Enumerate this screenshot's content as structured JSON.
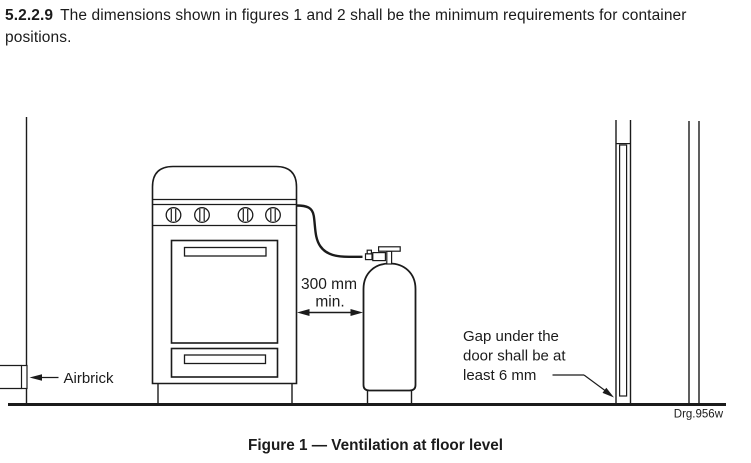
{
  "clause": {
    "number": "5.2.2.9",
    "text": "The dimensions shown in figures 1 and 2 shall be the minimum requirements for container positions."
  },
  "figure": {
    "caption": "Figure 1 — Ventilation at floor level",
    "drawing_ref": "Drg.956w",
    "labels": {
      "airbrick": "Airbrick",
      "clearance_value": "300 mm",
      "clearance_qualifier": "min.",
      "gap_note_line1": "Gap under the",
      "gap_note_line2": "door shall be at",
      "gap_note_line3": "least 6 mm"
    },
    "colors": {
      "line": "#1b1b1b",
      "background": "#ffffff"
    }
  }
}
